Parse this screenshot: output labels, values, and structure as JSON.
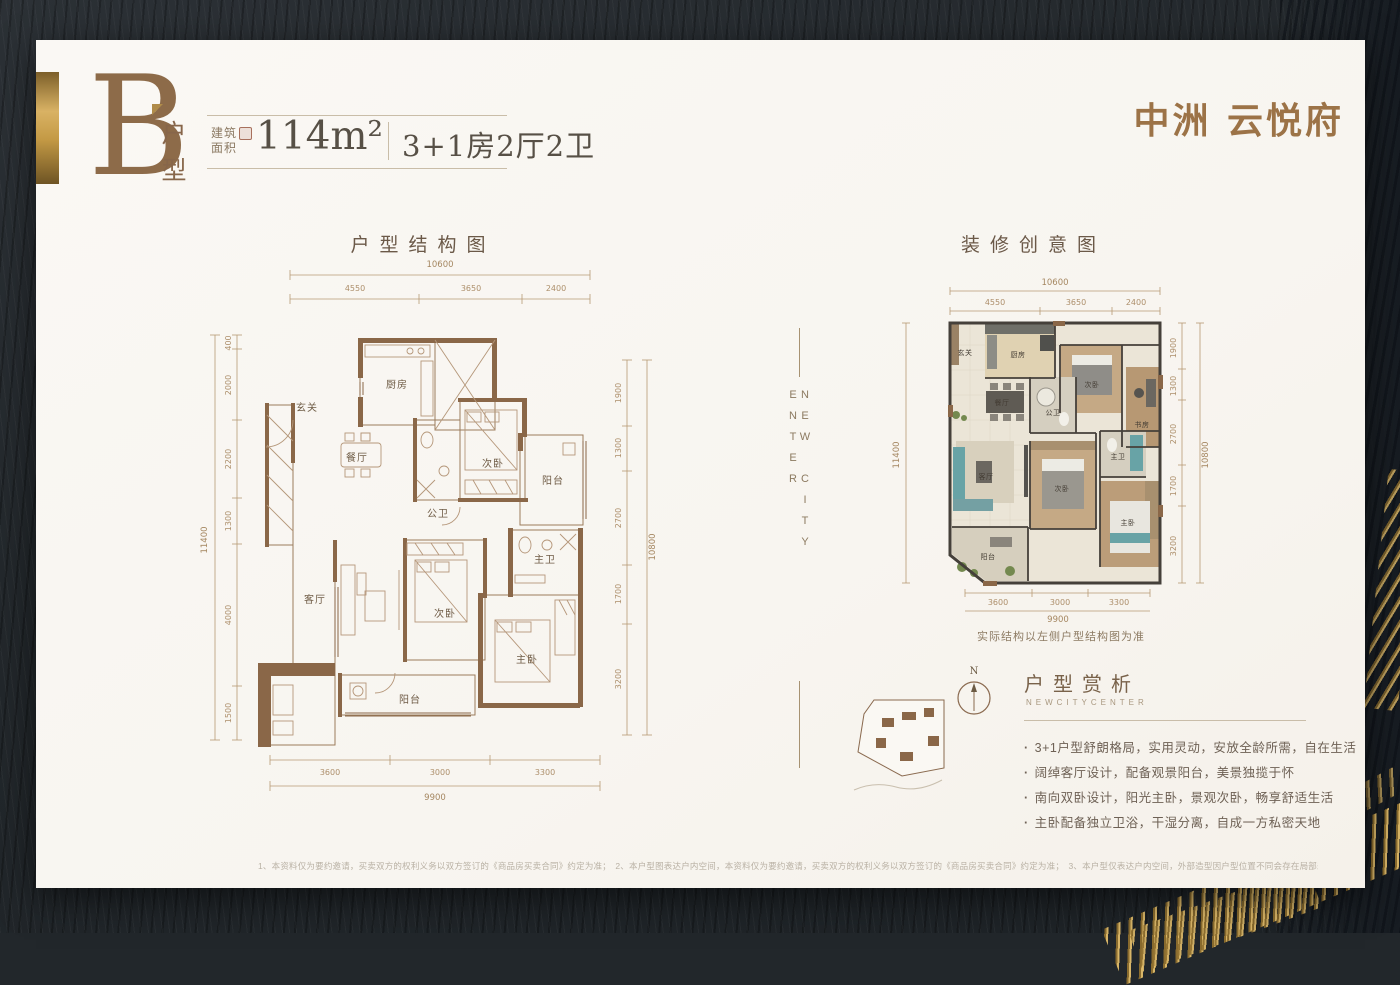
{
  "header": {
    "unit_letter": "B",
    "unit_type_label": "户型",
    "area_label": "建筑面积",
    "area_value": "114m²",
    "layout_value": "3+1房2厅2卫",
    "brand_logo": "中洲 云悦府"
  },
  "left_plan": {
    "title": "户型结构图",
    "dim_top_total": "10600",
    "dim_top": [
      "4550",
      "3650",
      "2400"
    ],
    "dim_left_total": "11400",
    "dim_left": [
      "400",
      "2000",
      "2200",
      "1300",
      "4000",
      "1500"
    ],
    "dim_right_total": "10800",
    "dim_right": [
      "1900",
      "1300",
      "2700",
      "1700",
      "3200"
    ],
    "dim_bottom_total": "9900",
    "dim_bottom": [
      "3600",
      "3000",
      "3300"
    ],
    "rooms": {
      "kitchen": "厨房",
      "foyer": "玄关",
      "dining": "餐厅",
      "guest_bath": "公卫",
      "bedroom2": "次卧",
      "balcony_side": "阳台",
      "living": "客厅",
      "bedroom3": "次卧",
      "master_bath": "主卫",
      "master_bedroom": "主卧",
      "balcony_main": "阳台"
    }
  },
  "right_plan": {
    "title": "装修创意图",
    "note": "实际结构以左侧户型结构图为准",
    "dim_top_total": "10600",
    "dim_top": [
      "4550",
      "3650",
      "2400"
    ],
    "dim_left_total": "11400",
    "dim_right_total": "10800",
    "dim_right": [
      "1900",
      "1300",
      "2700",
      "1700",
      "3200"
    ],
    "dim_bottom_total": "9900",
    "dim_bottom": [
      "3600",
      "3000",
      "3300"
    ],
    "rooms": {
      "foyer": "玄关",
      "kitchen": "厨房",
      "dining": "餐厅",
      "guest_bath": "公卫",
      "bedroom2": "次卧",
      "study": "书房",
      "living": "客厅",
      "bedroom3": "次卧",
      "master_bath": "主卫",
      "master_bedroom": "主卧",
      "balcony_main": "阳台"
    }
  },
  "divider": {
    "vertical_text": "NEW CITY ENTER"
  },
  "analysis": {
    "compass_label": "N",
    "title": "户型赏析",
    "subtitle": "NEWCITYCENTER",
    "bullets": [
      "3+1户型舒朗格局，实用灵动，安放全龄所需，自在生活",
      "阔绰客厅设计，配备观景阳台，美景独揽于怀",
      "南向双卧设计，阳光主卧，景观次卧，畅享舒适生活",
      "主卧配备独立卫浴，干湿分离，自成一方私密天地"
    ]
  },
  "footer": {
    "disclaimer": "1、本资料仅为要约邀请，买卖双方的权利义务以双方签订的《商品房买卖合同》约定为准；　2、本户型图表达户内空间，本资料仅为要约邀请，买卖双方的权利义务以双方签订的《商品房买卖合同》约定为准；　3、本户型仅表达户内空间，外部造型因户型位置不同会存在局部差异，同一类户型因不同楼栋不同楼层存在差异，结构布置仅为示意；　4、户型图中的家具、家电等设备仅为设计方案示意，不属于交付内容仅为示意，不属于"
  }
}
